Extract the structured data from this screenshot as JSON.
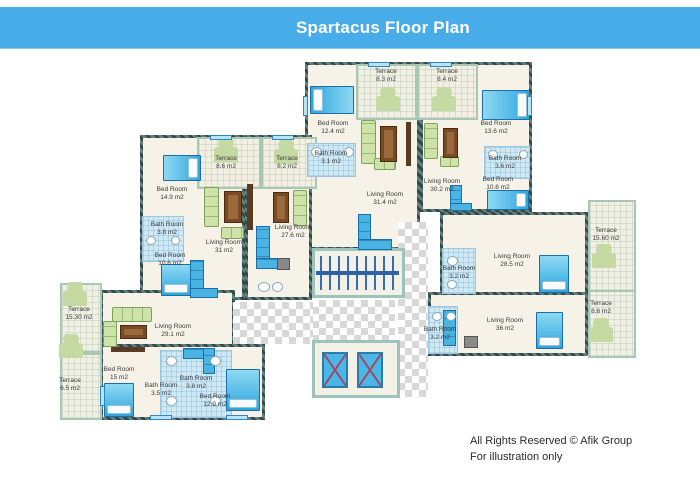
{
  "header": {
    "title": "Spartacus Floor Plan"
  },
  "footer": {
    "line1": "All Rights Reserved © Afik Group",
    "line2": "For illustration only"
  },
  "colors": {
    "header_bg": "#47ACE8",
    "header_text": "#FFFFFF",
    "wall": "#41585A",
    "floor": "#F6F2E7",
    "terrace_wall": "#A9C7B2",
    "bath_floor": "#CFE9F4",
    "bed_blue": "#49B4E4",
    "sofa_green": "#CDE3A8",
    "table_brown": "#7A4A22",
    "stair_rail": "#2E62A8"
  },
  "rooms": [
    {
      "id": "terrace-1",
      "name": "Terrace",
      "area": "8.3 m2",
      "x": 386,
      "y": 68
    },
    {
      "id": "terrace-2",
      "name": "Terrace",
      "area": "8.4 m2",
      "x": 447,
      "y": 68
    },
    {
      "id": "bedroom-1",
      "name": "Bed Room",
      "area": "12.4 m2",
      "x": 333,
      "y": 120
    },
    {
      "id": "bathroom-1",
      "name": "Bath Room",
      "area": "3.1 m2",
      "x": 331,
      "y": 150
    },
    {
      "id": "living-1",
      "name": "Living Room",
      "area": "31.4 m2",
      "x": 385,
      "y": 191
    },
    {
      "id": "living-2",
      "name": "Living Room",
      "area": "30.2 m2",
      "x": 442,
      "y": 178
    },
    {
      "id": "bedroom-2",
      "name": "Bed Room",
      "area": "13.6 m2",
      "x": 496,
      "y": 120
    },
    {
      "id": "bathroom-2",
      "name": "Bath Room",
      "area": "3.6 m2",
      "x": 505,
      "y": 155
    },
    {
      "id": "bedroom-3",
      "name": "Bed Room",
      "area": "10.6 m2",
      "x": 498,
      "y": 176
    },
    {
      "id": "terrace-3",
      "name": "Terrace",
      "area": "8.6 m2",
      "x": 226,
      "y": 155
    },
    {
      "id": "terrace-4",
      "name": "Terrace",
      "area": "8.2 m2",
      "x": 287,
      "y": 155
    },
    {
      "id": "bedroom-4",
      "name": "Bed Room",
      "area": "14.9 m2",
      "x": 172,
      "y": 186
    },
    {
      "id": "bathroom-3",
      "name": "Bath Room",
      "area": "3.8 m2",
      "x": 167,
      "y": 221
    },
    {
      "id": "bedroom-5",
      "name": "Bed Room",
      "area": "10.6 m2",
      "x": 170,
      "y": 252
    },
    {
      "id": "living-3",
      "name": "Living Room",
      "area": "31 m2",
      "x": 224,
      "y": 239
    },
    {
      "id": "living-4",
      "name": "Living Room",
      "area": "27.6  m2",
      "x": 293,
      "y": 224
    },
    {
      "id": "terrace-5",
      "name": "Terrace",
      "area": "15.30 m2",
      "x": 79,
      "y": 306
    },
    {
      "id": "terrace-6",
      "name": "Terrace",
      "area": "6.5 m2",
      "x": 70,
      "y": 377
    },
    {
      "id": "living-5",
      "name": "Living Room",
      "area": "29.1 m2",
      "x": 173,
      "y": 323
    },
    {
      "id": "bedroom-6",
      "name": "Bed Room",
      "area": "15 m2",
      "x": 119,
      "y": 366
    },
    {
      "id": "bathroom-4",
      "name": "Bath Room",
      "area": "3.5 m2",
      "x": 161,
      "y": 382
    },
    {
      "id": "bathroom-5",
      "name": "Bath Room",
      "area": "3.8 m2",
      "x": 196,
      "y": 375
    },
    {
      "id": "bedroom-7",
      "name": "Bed Room",
      "area": "12.9 m2",
      "x": 215,
      "y": 393
    },
    {
      "id": "terrace-7",
      "name": "Terrace",
      "area": "15.60 m2",
      "x": 606,
      "y": 227
    },
    {
      "id": "living-6",
      "name": "Living Room",
      "area": "28.5 m2",
      "x": 512,
      "y": 253
    },
    {
      "id": "bathroom-6",
      "name": "Bath Room",
      "area": "3.2 m2",
      "x": 459,
      "y": 265
    },
    {
      "id": "living-7",
      "name": "Living Room",
      "area": "36  m2",
      "x": 505,
      "y": 317
    },
    {
      "id": "bathroom-7",
      "name": "Bath Room",
      "area": "3.2 m2",
      "x": 440,
      "y": 326
    },
    {
      "id": "terrace-8",
      "name": "Terrace",
      "area": "8.6 m2",
      "x": 601,
      "y": 300
    }
  ]
}
